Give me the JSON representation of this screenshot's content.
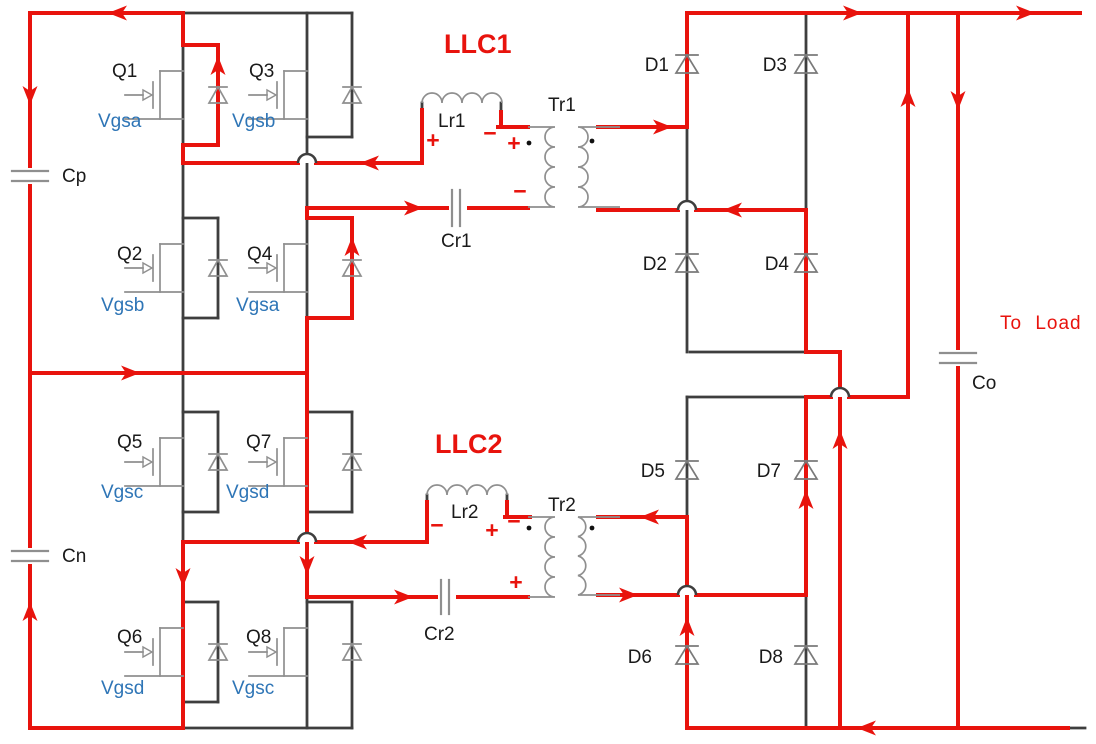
{
  "diagram_type": "power-electronics circuit schematic with current-flow annotation",
  "mosfets": [
    {
      "name": "Q1",
      "gate_signal": "Vgsa"
    },
    {
      "name": "Q2",
      "gate_signal": "Vgsb"
    },
    {
      "name": "Q3",
      "gate_signal": "Vgsb"
    },
    {
      "name": "Q4",
      "gate_signal": "Vgsa"
    },
    {
      "name": "Q5",
      "gate_signal": "Vgsc"
    },
    {
      "name": "Q6",
      "gate_signal": "Vgsd"
    },
    {
      "name": "Q7",
      "gate_signal": "Vgsd"
    },
    {
      "name": "Q8",
      "gate_signal": "Vgsc"
    }
  ],
  "diodes": [
    {
      "name": "D1"
    },
    {
      "name": "D2"
    },
    {
      "name": "D3"
    },
    {
      "name": "D4"
    },
    {
      "name": "D5"
    },
    {
      "name": "D6"
    },
    {
      "name": "D7"
    },
    {
      "name": "D8"
    }
  ],
  "capacitors": [
    {
      "name": "Cp"
    },
    {
      "name": "Cn"
    },
    {
      "name": "Cr1"
    },
    {
      "name": "Cr2"
    },
    {
      "name": "Co"
    }
  ],
  "inductors": [
    {
      "name": "Lr1"
    },
    {
      "name": "Lr2"
    }
  ],
  "transformers": [
    {
      "name": "Tr1"
    },
    {
      "name": "Tr2"
    }
  ],
  "resonant_tanks": [
    {
      "name": "LLC1"
    },
    {
      "name": "LLC2"
    }
  ],
  "output_label": "To Load",
  "polarity_marks": [
    {
      "symbol": "+"
    },
    {
      "symbol": "−"
    },
    {
      "symbol": "+"
    },
    {
      "symbol": "−"
    },
    {
      "symbol": "−"
    },
    {
      "symbol": "+"
    },
    {
      "symbol": "−"
    },
    {
      "symbol": "+"
    }
  ],
  "colors": {
    "current_path": "#e8130d",
    "wire": "#3e3e3e",
    "device": "#8f8f8f",
    "gate_label": "#2e75b6",
    "label": "#1a1a1a"
  }
}
